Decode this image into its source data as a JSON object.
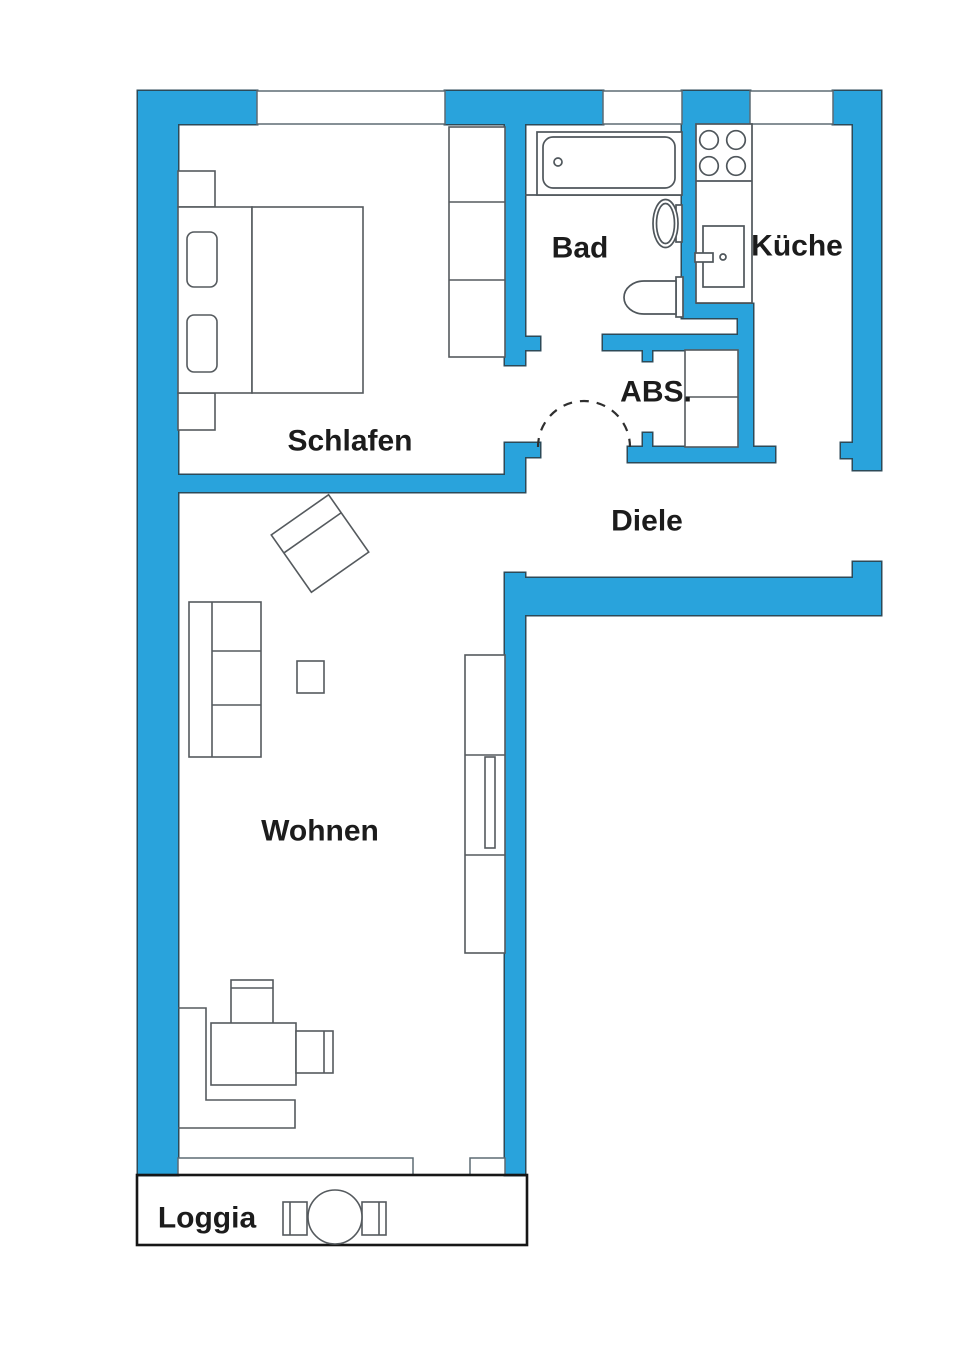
{
  "plan": {
    "type": "apartment-floor-plan",
    "rooms": {
      "schlafen": "Schlafen",
      "bad": "Bad",
      "kueche": "Küche",
      "abstellraum": "ABS.",
      "diele": "Diele",
      "wohnen": "Wohnen",
      "loggia": "Loggia"
    },
    "colors": {
      "wall_fill": "#29a3dc",
      "wall_outline": "#2c4a58",
      "furniture_line": "#555a5e",
      "text": "#1c1c1c",
      "loggia_outline": "#161616",
      "background": "#ffffff"
    }
  }
}
